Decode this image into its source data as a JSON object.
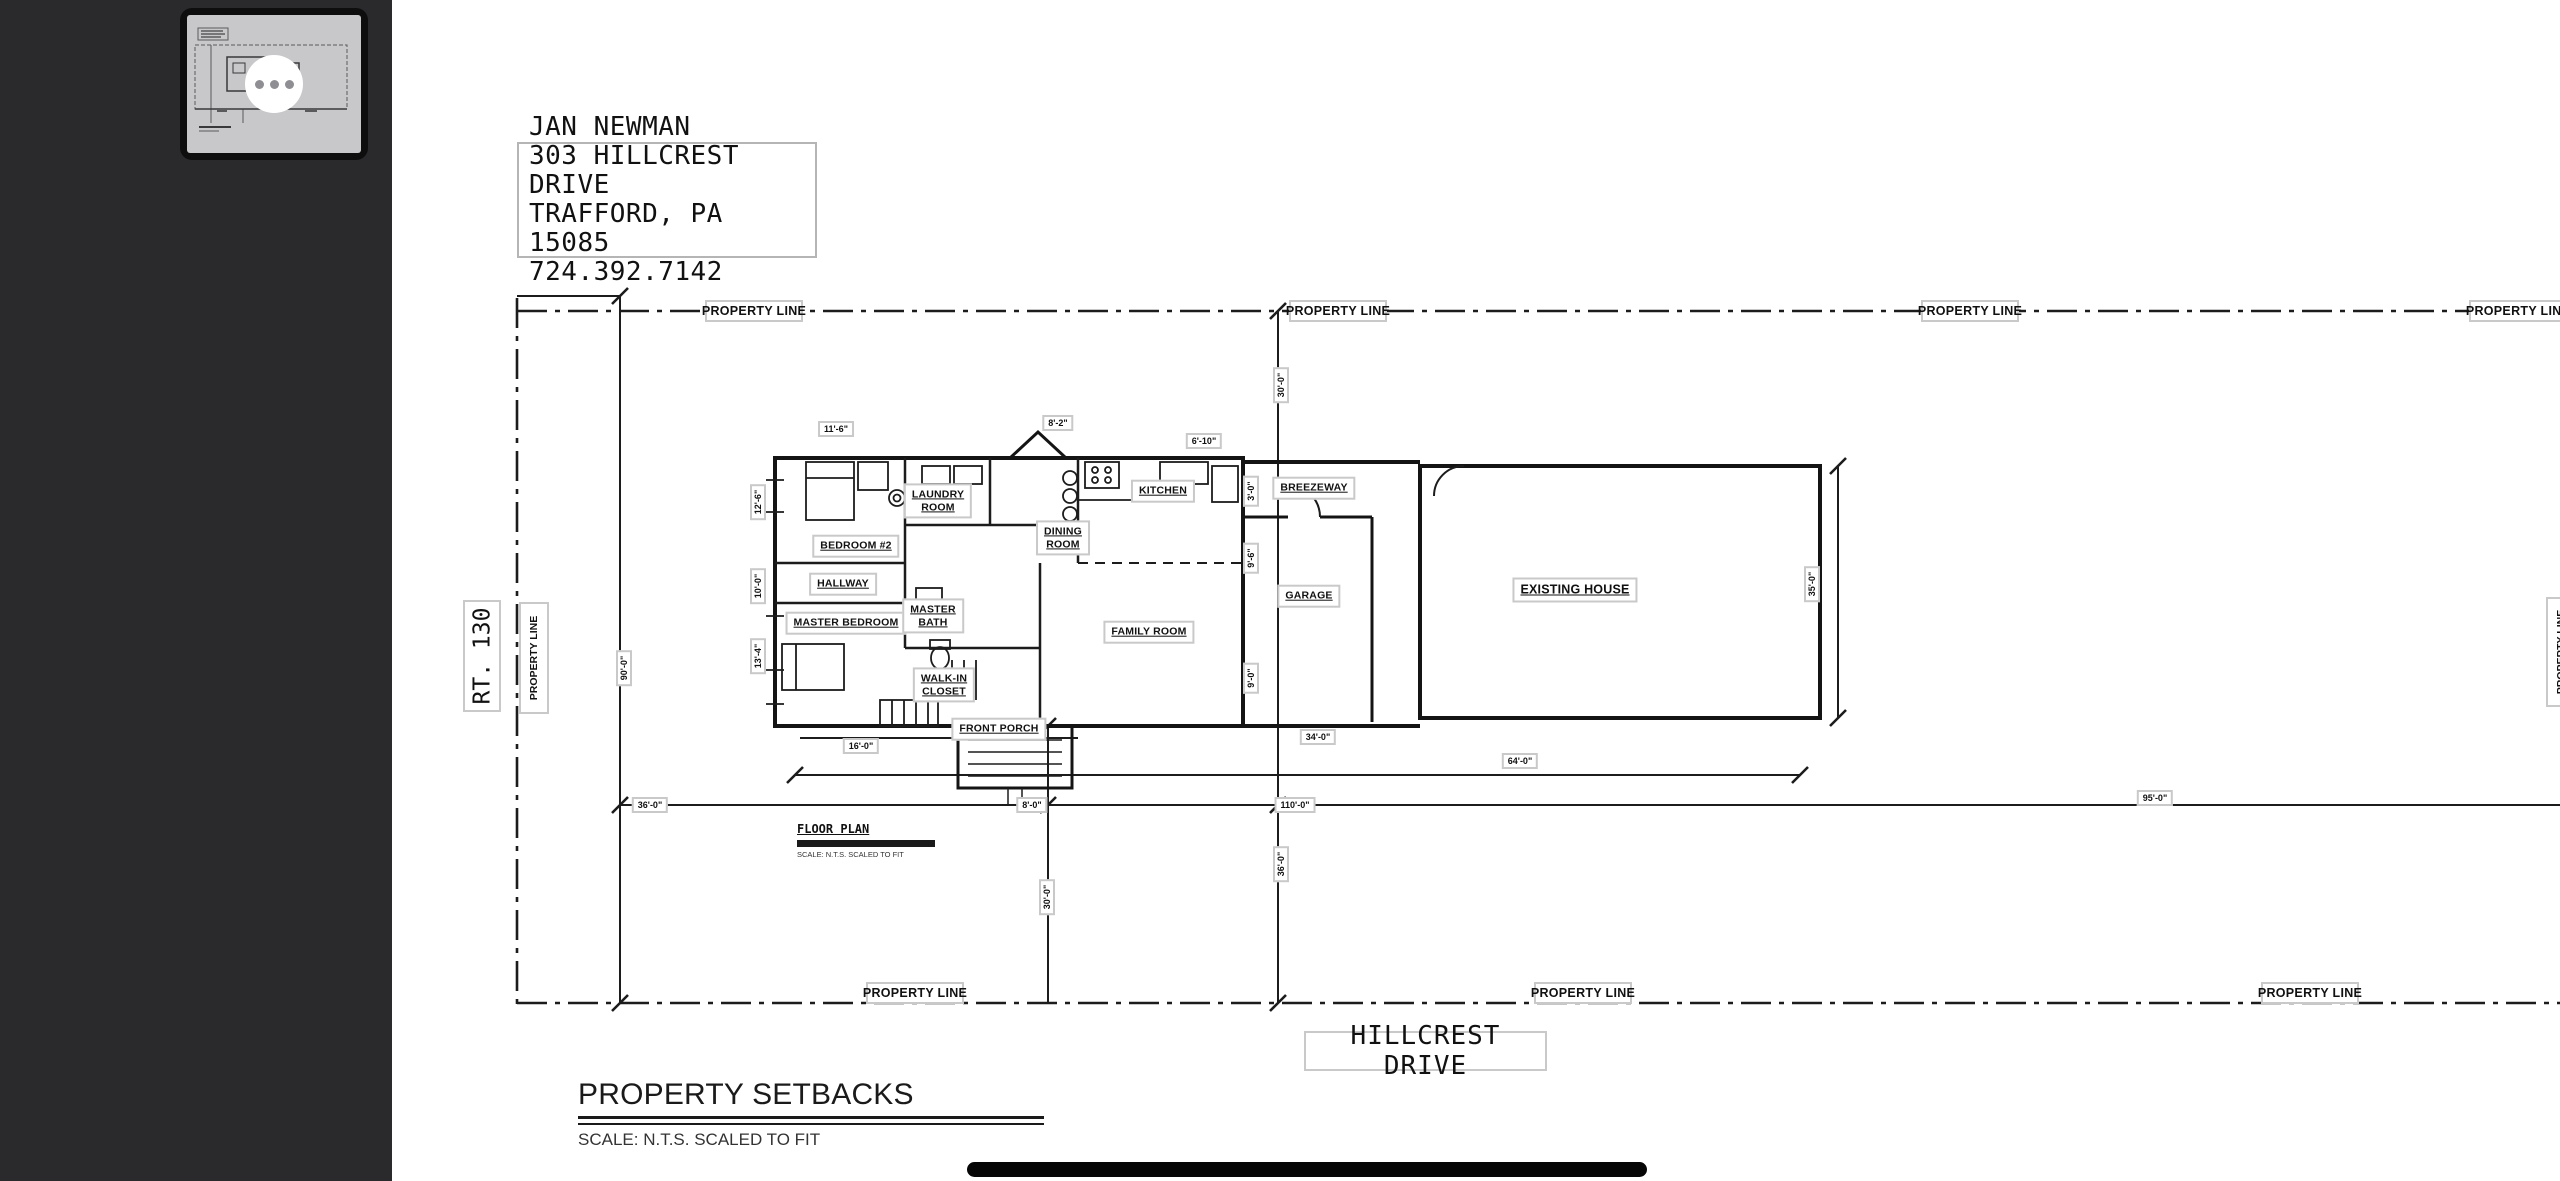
{
  "address": {
    "line1": "JAN NEWMAN",
    "line2": "303 HILLCREST DRIVE",
    "line3": "TRAFFORD, PA 15085",
    "line4": "724.392.7142"
  },
  "labels": {
    "property_line": "PROPERTY LINE",
    "rt_130": "RT. 130",
    "hillcrest_drive": "HILLCREST DRIVE",
    "floor_plan": "FLOOR PLAN",
    "floor_plan_scale": "SCALE: N.T.S. SCALED TO FIT",
    "setbacks_title": "PROPERTY SETBACKS",
    "setbacks_scale": "SCALE: N.T.S. SCALED TO FIT"
  },
  "rooms": {
    "bedroom2": "BEDROOM #2",
    "hallway": "HALLWAY",
    "master_bedroom": "MASTER BEDROOM",
    "laundry": "LAUNDRY\nROOM",
    "master_bath": "MASTER\nBATH",
    "walkin_closet": "WALK-IN\nCLOSET",
    "front_porch": "FRONT PORCH",
    "kitchen": "KITCHEN",
    "dining": "DINING\nROOM",
    "family_room": "FAMILY ROOM",
    "breezeway": "BREEZEWAY",
    "garage": "GARAGE",
    "existing_house": "EXISTING HOUSE"
  },
  "dims": {
    "top_a": "11'-6\"",
    "top_b": "8'-2\"",
    "top_c": "6'-10\"",
    "left_a": "12'-6\"",
    "left_b": "10'-0\"",
    "left_c": "13'-4\"",
    "lot_left": "90'-0\"",
    "front_top": "30'-0\"",
    "mid_a": "3'-0\"",
    "mid_b": "9'-6\"",
    "mid_c": "9'-0\"",
    "front_bottom": "36'-0\"",
    "walk": "30'-0\"",
    "existing_side": "35'-0\"",
    "porch_w": "16'-0\"",
    "step_w": "8'-0\"",
    "row_a": "36'-0\"",
    "row_b": "110'-0\"",
    "row_c": "95'-0\"",
    "garage_w": "34'-0\"",
    "existing_w": "64'-0\""
  }
}
